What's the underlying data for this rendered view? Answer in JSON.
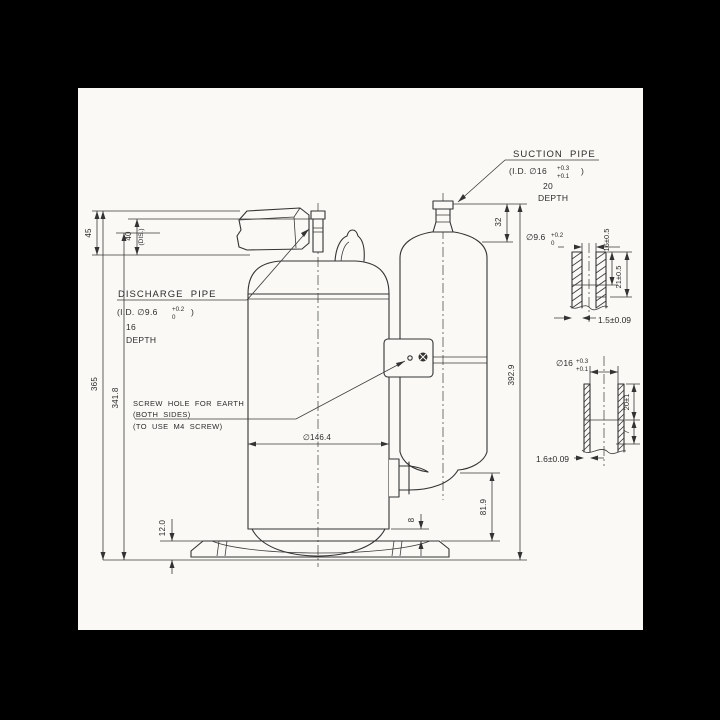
{
  "labels": {
    "suction": {
      "title": "SUCTION  PIPE",
      "id_open": "(I.D. ∅16",
      "tol_up": "+0.3",
      "tol_dn": "+0.1",
      "id_close": ")",
      "depth": "20",
      "depth_word": "DEPTH"
    },
    "discharge": {
      "title": "DISCHARGE  PIPE",
      "id_open": "(I.D. ∅9.6",
      "tol_up": "+0.2",
      "tol_dn": "0",
      "id_close": ")",
      "depth": "16",
      "depth_word": "DEPTH"
    },
    "earth": {
      "line1": "SCREW  HOLE  FOR  EARTH",
      "line2": "(BOTH  SIDES)",
      "line3": "(TO  USE  M4  SCREW)"
    }
  },
  "dims": {
    "overall_height": "365",
    "shell_height": "341.8",
    "top_clearance": "45",
    "discharge_offset": "40",
    "discharge_note": "(DIS.)",
    "suction_stub": "32",
    "accumulator_height": "392.9",
    "shell_diameter": "∅146.4",
    "inlet_height": "81.9",
    "shell_base_gap": "8",
    "base_height": "12.0"
  },
  "detail_discharge": {
    "bore": "∅9.6",
    "tol_up": "+0.2",
    "tol_dn": "0",
    "depth_a": "16±0.5",
    "depth_b": "21±0.5",
    "wall": "1.5±0.09"
  },
  "detail_suction": {
    "bore": "∅16",
    "tol_up": "+0.3",
    "tol_dn": "+0.1",
    "depth_a": "20±1",
    "depth_b": "7",
    "wall": "1.6±0.09"
  },
  "colors": {
    "paper": "#faf9f5",
    "ink": "#333333",
    "frame": "#000000"
  }
}
